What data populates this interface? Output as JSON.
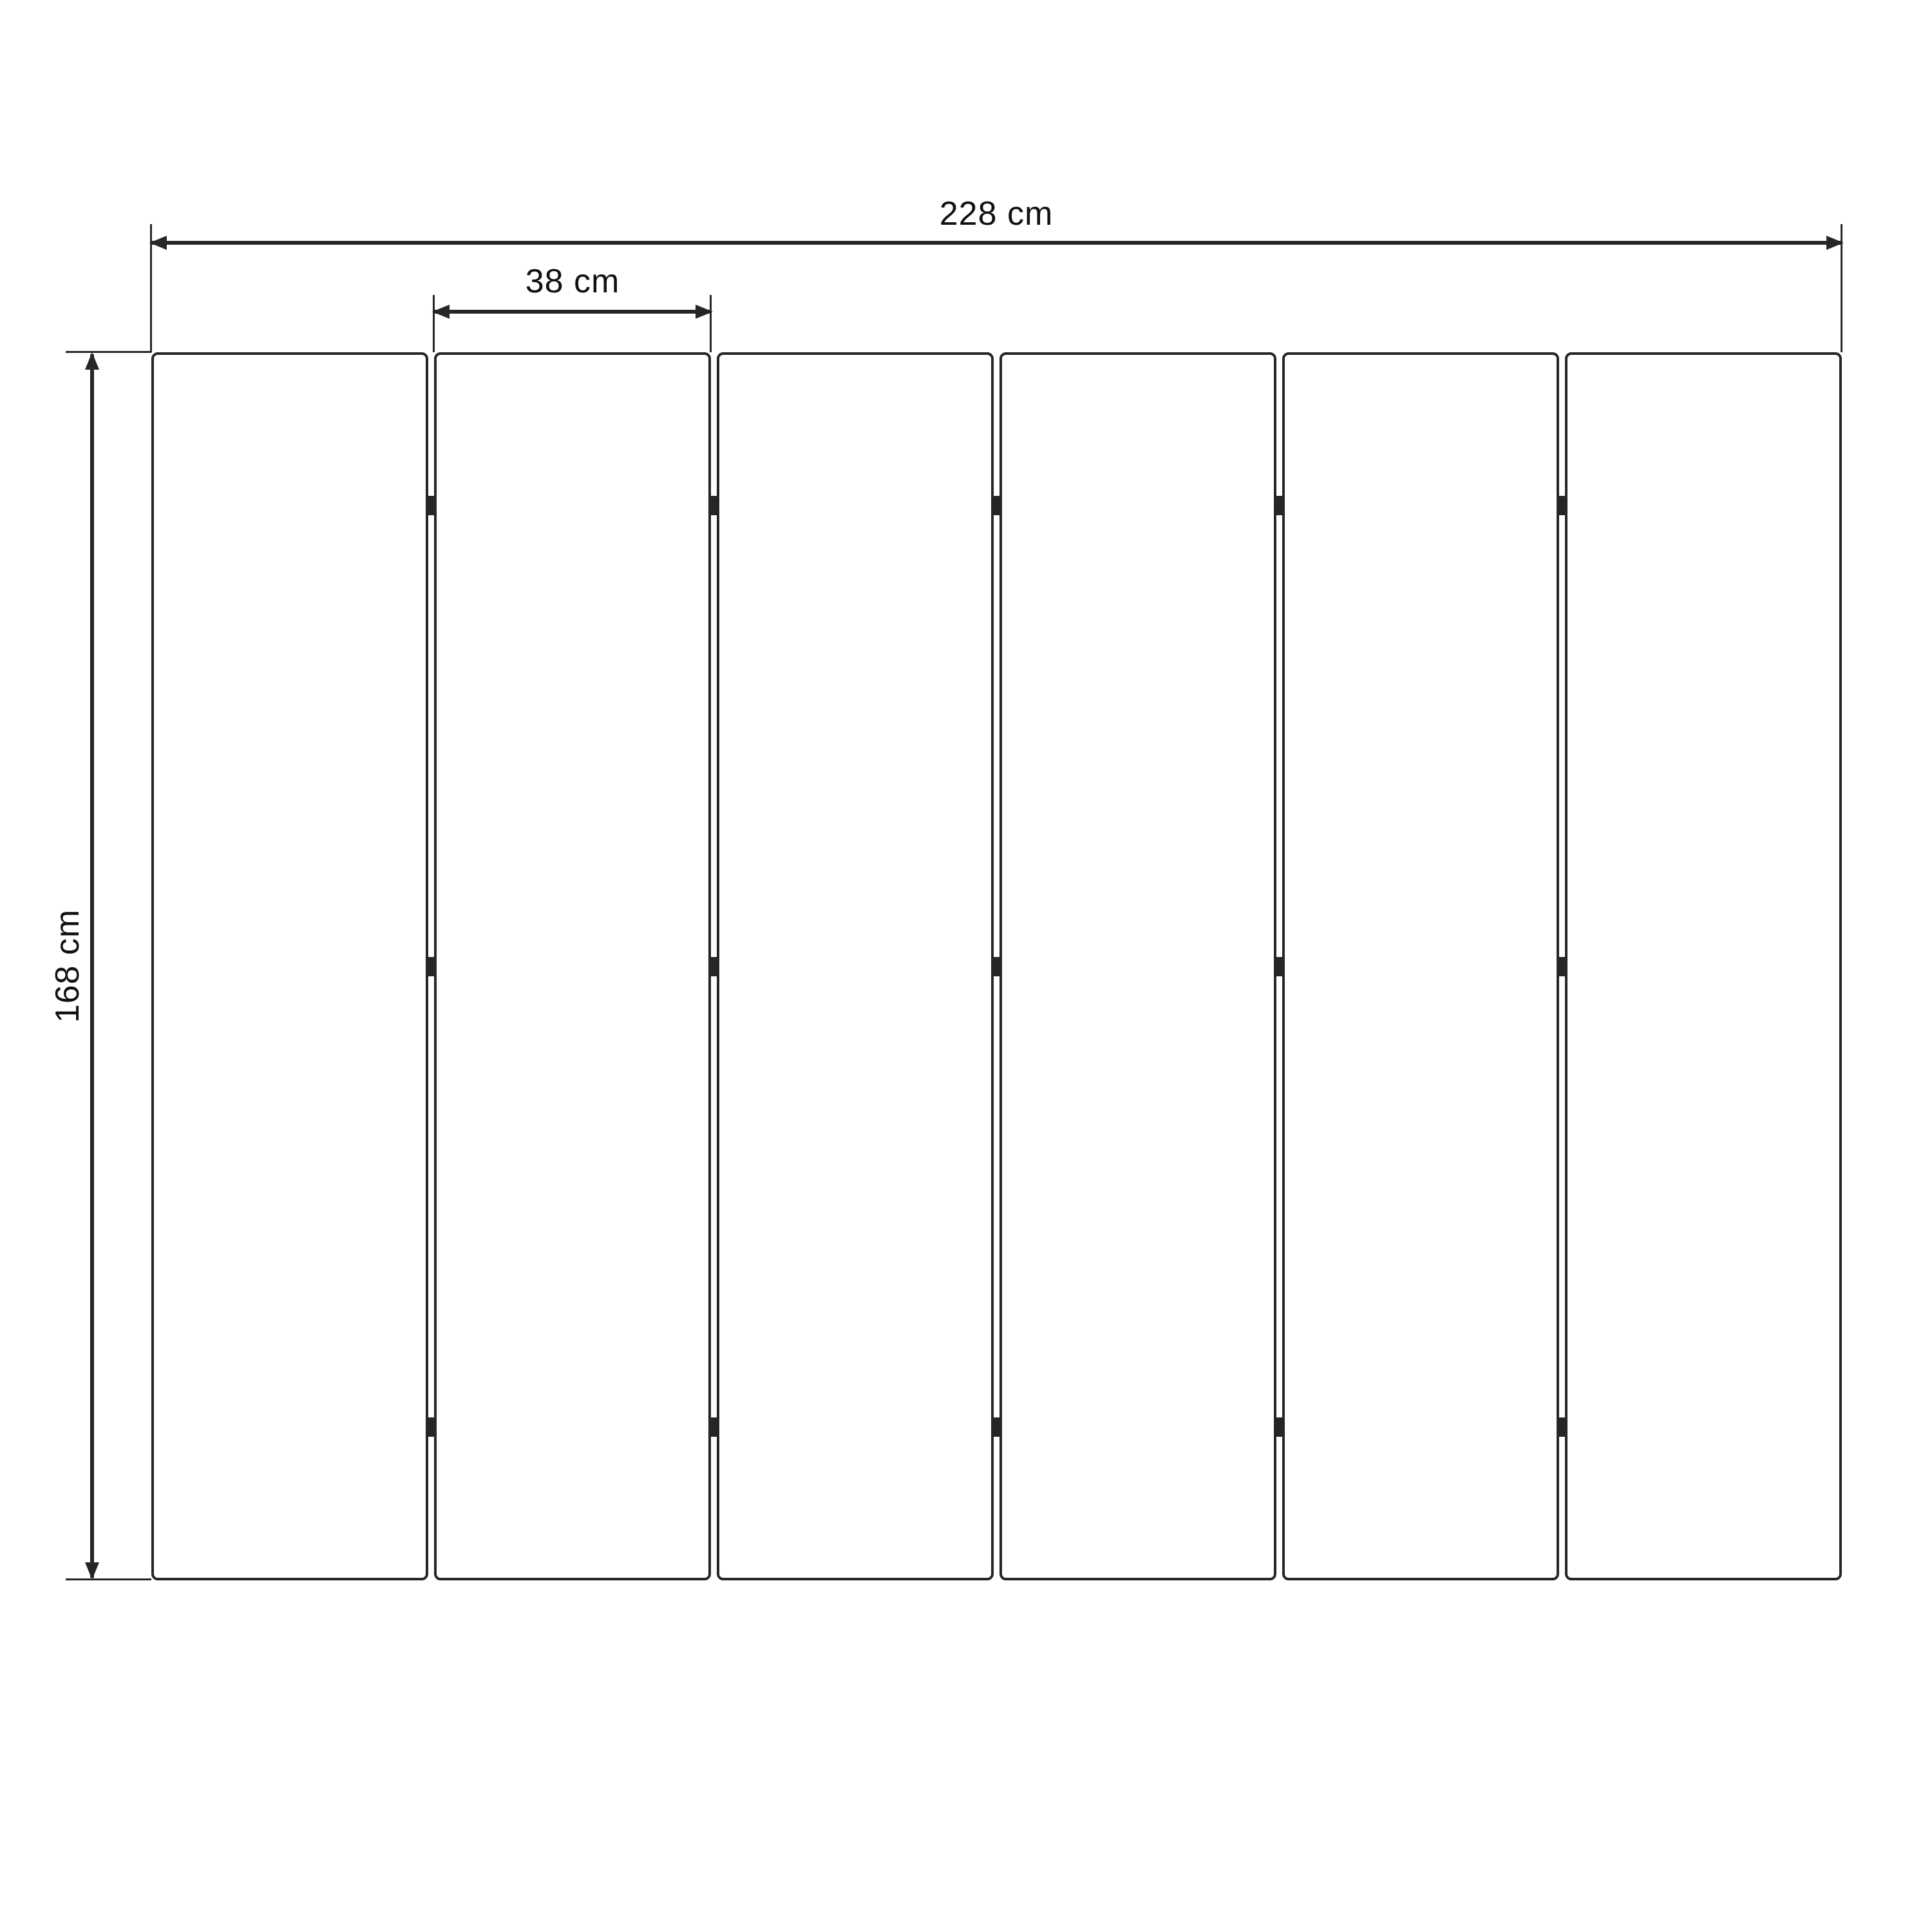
{
  "dimensions": {
    "total_width_label": "228 cm",
    "panel_width_label": "38 cm",
    "height_label": "168 cm"
  },
  "panels": {
    "count": 6,
    "joints": 5,
    "hinges_per_joint": 3
  },
  "colors": {
    "line": "#262626",
    "text": "#111111",
    "background": "#ffffff"
  }
}
